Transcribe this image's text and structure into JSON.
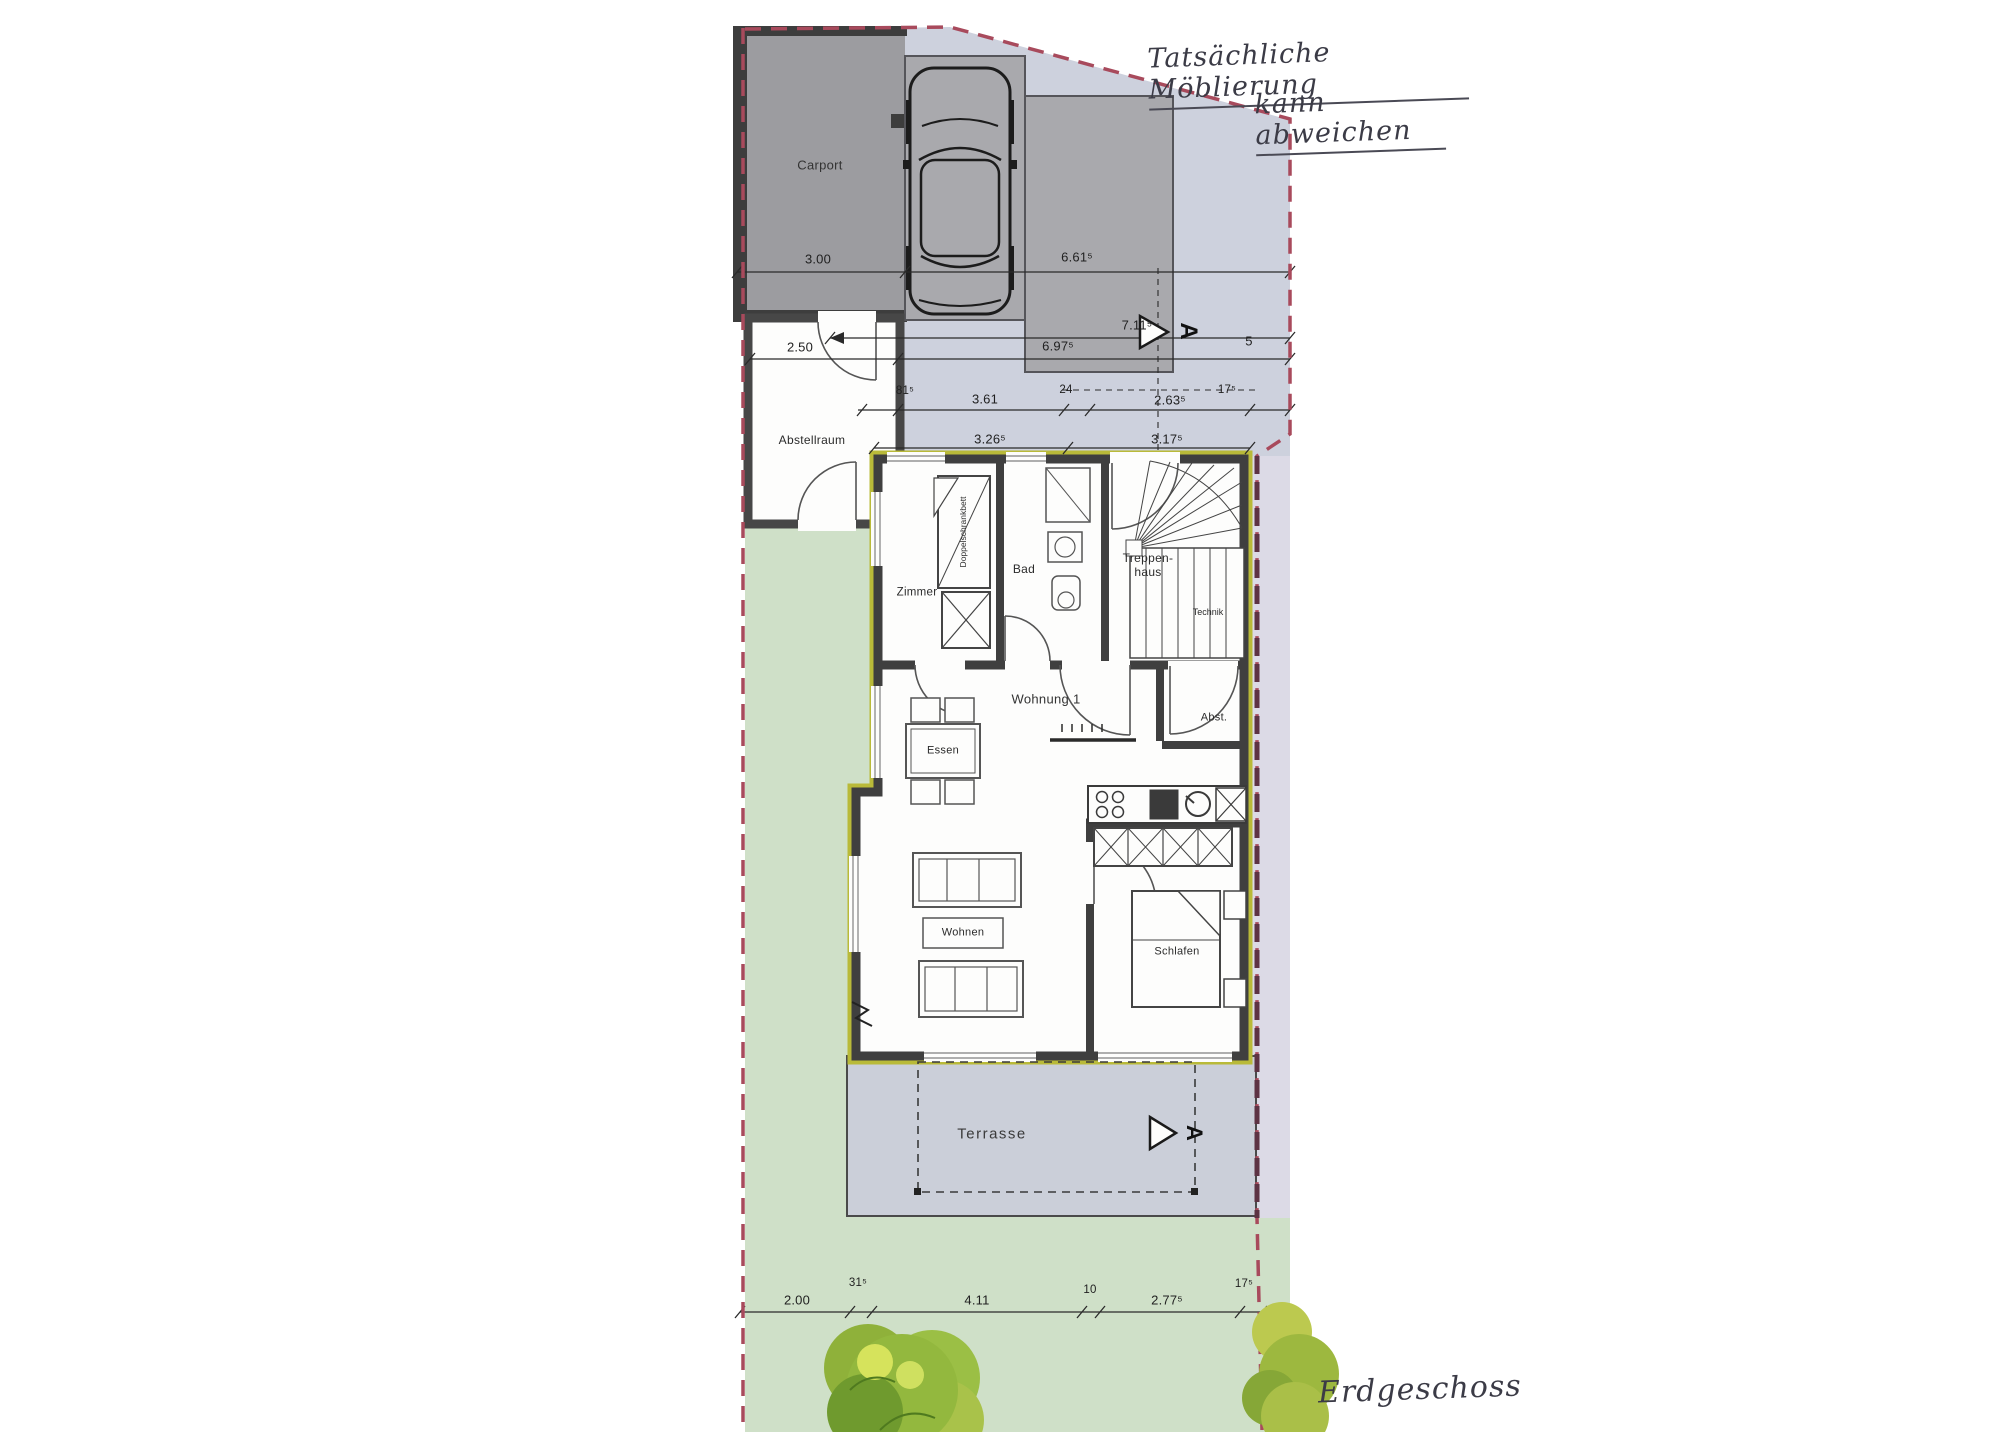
{
  "handwritten": {
    "line1": "Tatsächliche Möblierung",
    "line2": "kann abweichen",
    "floor": "Erdgeschoss"
  },
  "rooms": {
    "carport": "Carport",
    "abstellraum": "Abstellraum",
    "zimmer": "Zimmer",
    "bad": "Bad",
    "treppenhaus": "Treppen-\nhaus",
    "technik": "Technik",
    "wohnung1": "Wohnung 1",
    "abst": "Abst.",
    "essen": "Essen",
    "wohnen": "Wohnen",
    "schlafen": "Schlafen",
    "terrasse": "Terrasse",
    "schrankbett": "Doppelschrankbett"
  },
  "dims": {
    "carport_width": "3.00",
    "drive_width": "6.61⁵",
    "total_711": "7.11⁵",
    "abstell_width": "2.50",
    "total_697": "6.97⁵",
    "gap_5": "5",
    "r81": "81⁵",
    "r361": "3.61",
    "r24": "24",
    "r263": "2.63⁵",
    "r17": "17⁵",
    "r326": "3.26⁵",
    "r317": "3.17⁵",
    "b200": "2.00",
    "b31": "31⁵",
    "b411": "4.11",
    "b10": "10",
    "b277": "2.77⁵",
    "b17": "17⁵"
  },
  "section_marker": "A",
  "colors": {
    "paving": "#cdd1dd",
    "terrace": "#cbcfd9",
    "garden": "#cfe0c8",
    "carport": "#9c9ca0",
    "parking_pad": "#a9a9ad",
    "wall": "#3f3f3f",
    "building_outline": "#b9ba39",
    "boundary": "#a84a5c"
  }
}
